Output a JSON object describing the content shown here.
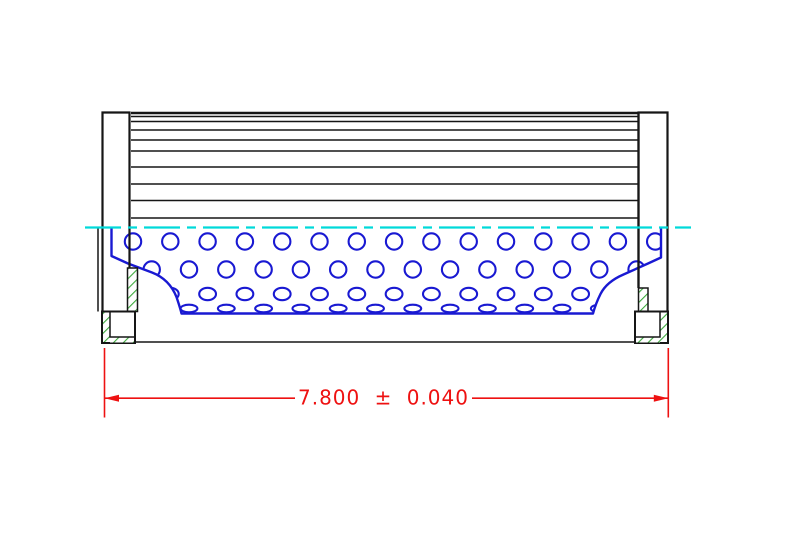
{
  "dimension": {
    "value": "7.800",
    "symbol": "±",
    "tolerance": "0.040",
    "label": "7.800 ± 0.040"
  },
  "colors": {
    "line": "#161616",
    "blue": "#1919d2",
    "cyan": "#00d9d9",
    "green": "#3caa3c",
    "red": "#ee1111",
    "background": "#ffffff"
  },
  "drawing": {
    "pleat_block": {
      "x1": 131,
      "x2": 639,
      "top": 113,
      "bottom": 218,
      "line_ys": [
        116.5,
        121.5,
        130,
        140,
        151,
        167,
        184,
        200.5
      ]
    },
    "centerline": {
      "y": 227.5,
      "x1": 85,
      "x2": 691,
      "dash": [
        36,
        7,
        9,
        7
      ]
    },
    "holes": {
      "step": 37.3,
      "rows": [
        {
          "y": 241.5,
          "rx": 8.2,
          "ry": 8.2,
          "x0": 133.0,
          "n": 15
        },
        {
          "y": 269.5,
          "rx": 8.2,
          "ry": 8.2,
          "x0": 151.7,
          "n": 14
        },
        {
          "y": 294.0,
          "rx": 8.4,
          "ry": 6.2,
          "x0": 170.3,
          "n": 13
        },
        {
          "y": 308.5,
          "rx": 8.4,
          "ry": 3.8,
          "x0": 151.7,
          "n": 13
        }
      ]
    }
  }
}
